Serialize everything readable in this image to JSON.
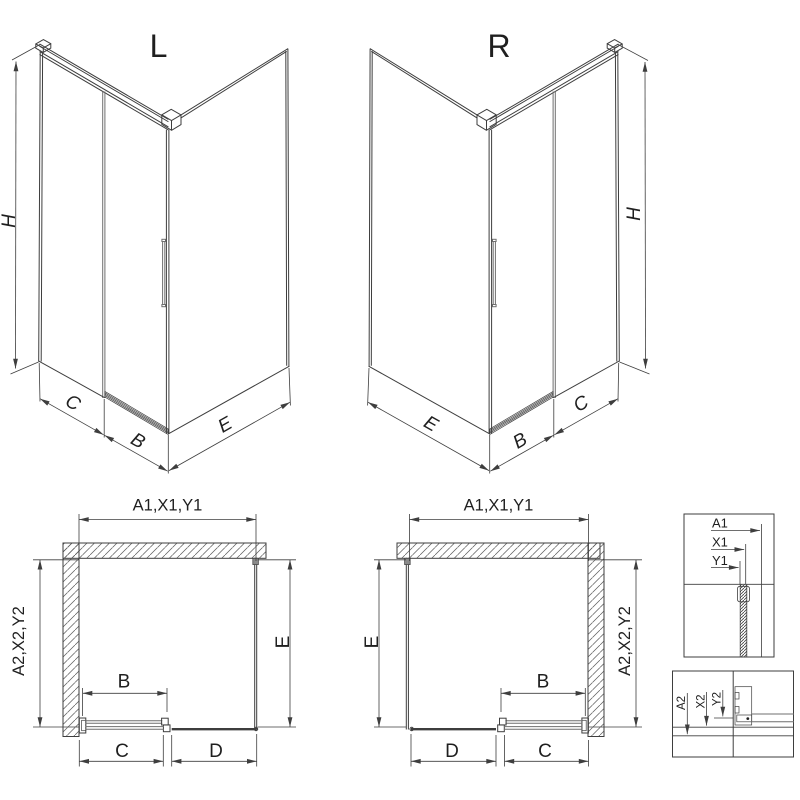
{
  "colors": {
    "line": "#3e3e3e",
    "text": "#1f1f1f",
    "background": "#ffffff"
  },
  "iso_left": {
    "title": "L",
    "dim_height": "H",
    "dim_c": "C",
    "dim_b": "B",
    "dim_e": "E"
  },
  "iso_right": {
    "title": "R",
    "dim_height": "H",
    "dim_c": "C",
    "dim_b": "B",
    "dim_e": "E"
  },
  "plan_left": {
    "dim_top": "A1,X1,Y1",
    "dim_left": "A2,X2,Y2",
    "dim_right": "E",
    "dim_b": "B",
    "dim_c": "C",
    "dim_d": "D"
  },
  "plan_right": {
    "dim_top": "A1,X1,Y1",
    "dim_right": "A2,X2,Y2",
    "dim_left": "E",
    "dim_b": "B",
    "dim_c": "C",
    "dim_d": "D"
  },
  "detail_top": {
    "label_a1": "A1",
    "label_x1": "X1",
    "label_y1": "Y1"
  },
  "detail_bottom": {
    "label_a2": "A2",
    "label_x2": "X2",
    "label_y2": "Y2"
  }
}
